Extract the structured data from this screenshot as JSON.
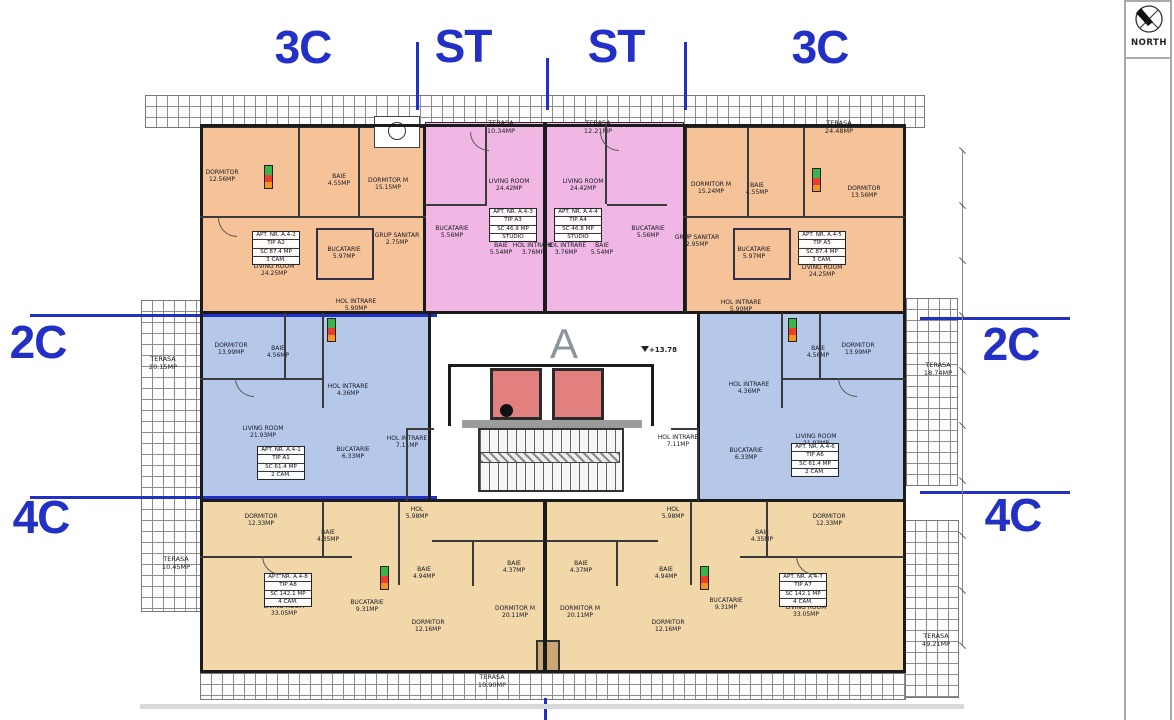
{
  "compass": {
    "label": "NORTH"
  },
  "core": {
    "letter": "A",
    "level": "+13.78"
  },
  "colors": {
    "accent_blue": "#2330c6",
    "apartment_3c_orange": "#f5c397",
    "apartment_st_pink": "#f0b6e4",
    "apartment_2c_blue": "#b5c8e9",
    "apartment_4c_tan": "#f2d7a9",
    "elevator_red": "#e28080"
  },
  "section_labels": [
    {
      "text": "3C",
      "x": 303,
      "y": 47
    },
    {
      "text": "ST",
      "x": 463,
      "y": 46
    },
    {
      "text": "ST",
      "x": 616,
      "y": 46
    },
    {
      "text": "3C",
      "x": 820,
      "y": 47
    },
    {
      "text": "2C",
      "x": 38,
      "y": 342
    },
    {
      "text": "4C",
      "x": 41,
      "y": 517
    },
    {
      "text": "2C",
      "x": 1011,
      "y": 344
    },
    {
      "text": "4C",
      "x": 1013,
      "y": 515
    }
  ],
  "apartment_boxes": [
    {
      "id": "a4-1",
      "lines": [
        "APT. NR. A.4-1",
        "TIP A1",
        "SC 61.4 MP",
        "2 CAM."
      ],
      "x": 281,
      "y": 463
    },
    {
      "id": "a4-2",
      "lines": [
        "APT. NR. A.4-2",
        "TIP A2",
        "SC 87.4 MP",
        "3 CAM."
      ],
      "x": 276,
      "y": 248
    },
    {
      "id": "a4-3",
      "lines": [
        "APT. NR. A.4-3",
        "TIP A3",
        "SC 46.9 MP",
        "STUDIO"
      ],
      "x": 513,
      "y": 225
    },
    {
      "id": "a4-4",
      "lines": [
        "APT. NR. A.4-4",
        "TIP A4",
        "SC 46.8 MP",
        "STUDIO"
      ],
      "x": 578,
      "y": 225
    },
    {
      "id": "a4-5",
      "lines": [
        "APT. NR. A.4-5",
        "TIP A5",
        "SC 87.4 MP",
        "3 CAM."
      ],
      "x": 822,
      "y": 248
    },
    {
      "id": "a4-6",
      "lines": [
        "APT. NR. A.4-6",
        "TIP A6",
        "SC 61.4 MP",
        "2 CAM."
      ],
      "x": 815,
      "y": 460
    },
    {
      "id": "a4-7",
      "lines": [
        "APT. NR. A.4-7",
        "TIP A7",
        "SC 142.1 MP",
        "4 CAM."
      ],
      "x": 803,
      "y": 590
    },
    {
      "id": "a4-8",
      "lines": [
        "APT. NR. A.4-8",
        "TIP A8",
        "SC 142.1 MP",
        "4 CAM."
      ],
      "x": 288,
      "y": 590
    }
  ],
  "room_labels": [
    {
      "lines": [
        "DORMITOR",
        "12.56MP"
      ],
      "x": 222,
      "y": 176
    },
    {
      "lines": [
        "BAIE",
        "4.55MP"
      ],
      "x": 339,
      "y": 180
    },
    {
      "lines": [
        "DORMITOR M",
        "15.15MP"
      ],
      "x": 388,
      "y": 184
    },
    {
      "lines": [
        "GRUP SANITAR",
        "2.75MP"
      ],
      "x": 397,
      "y": 239
    },
    {
      "lines": [
        "BUCATARIE",
        "5.97MP"
      ],
      "x": 344,
      "y": 253
    },
    {
      "lines": [
        "LIVING ROOM",
        "24.25MP"
      ],
      "x": 274,
      "y": 270
    },
    {
      "lines": [
        "HOL INTRARE",
        "5.90MP"
      ],
      "x": 356,
      "y": 305
    },
    {
      "lines": [
        "LIVING ROOM",
        "24.42MP"
      ],
      "x": 509,
      "y": 185
    },
    {
      "lines": [
        "BUCATARIE",
        "5.56MP"
      ],
      "x": 452,
      "y": 232
    },
    {
      "lines": [
        "BAIE",
        "5.54MP"
      ],
      "x": 501,
      "y": 249
    },
    {
      "lines": [
        "HOL INTRARE",
        "3.76MP"
      ],
      "x": 533,
      "y": 249
    },
    {
      "lines": [
        "LIVING ROOM",
        "24.42MP"
      ],
      "x": 583,
      "y": 185
    },
    {
      "lines": [
        "HOL INTRARE",
        "3.76MP"
      ],
      "x": 566,
      "y": 249
    },
    {
      "lines": [
        "BAIE",
        "5.54MP"
      ],
      "x": 602,
      "y": 249
    },
    {
      "lines": [
        "BUCATARIE",
        "5.56MP"
      ],
      "x": 648,
      "y": 232
    },
    {
      "lines": [
        "DORMITOR M",
        "15.24MP"
      ],
      "x": 711,
      "y": 188
    },
    {
      "lines": [
        "BAIE",
        "4.55MP"
      ],
      "x": 757,
      "y": 189
    },
    {
      "lines": [
        "DORMITOR",
        "13.56MP"
      ],
      "x": 864,
      "y": 192
    },
    {
      "lines": [
        "GRUP SANITAR",
        "2.95MP"
      ],
      "x": 697,
      "y": 241
    },
    {
      "lines": [
        "BUCATARIE",
        "5.97MP"
      ],
      "x": 754,
      "y": 253
    },
    {
      "lines": [
        "LIVING ROOM",
        "24.25MP"
      ],
      "x": 822,
      "y": 271
    },
    {
      "lines": [
        "HOL INTRARE",
        "5.90MP"
      ],
      "x": 741,
      "y": 306
    },
    {
      "lines": [
        "DORMITOR",
        "13.99MP"
      ],
      "x": 231,
      "y": 349
    },
    {
      "lines": [
        "BAIE",
        "4.56MP"
      ],
      "x": 278,
      "y": 352
    },
    {
      "lines": [
        "HOL INTRARE",
        "4.36MP"
      ],
      "x": 348,
      "y": 390
    },
    {
      "lines": [
        "LIVING ROOM",
        "21.93MP"
      ],
      "x": 263,
      "y": 432
    },
    {
      "lines": [
        "BUCATARIE",
        "6.33MP"
      ],
      "x": 353,
      "y": 453
    },
    {
      "lines": [
        "BAIE",
        "4.56MP"
      ],
      "x": 818,
      "y": 352
    },
    {
      "lines": [
        "DORMITOR",
        "13.99MP"
      ],
      "x": 858,
      "y": 349
    },
    {
      "lines": [
        "HOL INTRARE",
        "4.36MP"
      ],
      "x": 749,
      "y": 388
    },
    {
      "lines": [
        "LIVING ROOM",
        "21.93MP"
      ],
      "x": 816,
      "y": 440
    },
    {
      "lines": [
        "BUCATARIE",
        "6.33MP"
      ],
      "x": 746,
      "y": 454
    },
    {
      "lines": [
        "HOL INTRARE",
        "7.11MP"
      ],
      "x": 407,
      "y": 442
    },
    {
      "lines": [
        "HOL INTRARE",
        "7.11MP"
      ],
      "x": 678,
      "y": 441
    },
    {
      "lines": [
        "HOL",
        "5.98MP"
      ],
      "x": 417,
      "y": 513
    },
    {
      "lines": [
        "HOL",
        "5.98MP"
      ],
      "x": 673,
      "y": 513
    },
    {
      "lines": [
        "DORMITOR",
        "12.33MP"
      ],
      "x": 261,
      "y": 520
    },
    {
      "lines": [
        "BAIE",
        "4.35MP"
      ],
      "x": 328,
      "y": 536
    },
    {
      "lines": [
        "LIVING ROOM",
        "33.05MP"
      ],
      "x": 284,
      "y": 610
    },
    {
      "lines": [
        "BUCATARIE",
        "9.31MP"
      ],
      "x": 367,
      "y": 606
    },
    {
      "lines": [
        "DORMITOR",
        "12.16MP"
      ],
      "x": 428,
      "y": 626
    },
    {
      "lines": [
        "BAIE",
        "4.94MP"
      ],
      "x": 424,
      "y": 573
    },
    {
      "lines": [
        "BAIE",
        "4.37MP"
      ],
      "x": 514,
      "y": 567
    },
    {
      "lines": [
        "DORMITOR M",
        "20.11MP"
      ],
      "x": 515,
      "y": 612
    },
    {
      "lines": [
        "BAIE",
        "4.37MP"
      ],
      "x": 581,
      "y": 567
    },
    {
      "lines": [
        "DORMITOR M",
        "20.11MP"
      ],
      "x": 580,
      "y": 612
    },
    {
      "lines": [
        "BAIE",
        "4.94MP"
      ],
      "x": 666,
      "y": 573
    },
    {
      "lines": [
        "DORMITOR",
        "12.16MP"
      ],
      "x": 668,
      "y": 626
    },
    {
      "lines": [
        "BUCATARIE",
        "9.31MP"
      ],
      "x": 726,
      "y": 604
    },
    {
      "lines": [
        "LIVING ROOM",
        "33.05MP"
      ],
      "x": 806,
      "y": 611
    },
    {
      "lines": [
        "DORMITOR",
        "12.33MP"
      ],
      "x": 829,
      "y": 520
    },
    {
      "lines": [
        "BAIE",
        "4.35MP"
      ],
      "x": 762,
      "y": 536
    }
  ],
  "terrace_labels": [
    {
      "lines": [
        "TERASA",
        "10.34MP"
      ],
      "x": 501,
      "y": 128
    },
    {
      "lines": [
        "TERASA",
        "12.21MP"
      ],
      "x": 598,
      "y": 128
    },
    {
      "lines": [
        "TERASA",
        "24.48MP"
      ],
      "x": 839,
      "y": 128
    },
    {
      "lines": [
        "TERASA",
        "20.15MP"
      ],
      "x": 163,
      "y": 364
    },
    {
      "lines": [
        "TERASA",
        "18.74MP"
      ],
      "x": 938,
      "y": 370
    },
    {
      "lines": [
        "TERASA",
        "10.45MP"
      ],
      "x": 176,
      "y": 564
    },
    {
      "lines": [
        "TERASA",
        "10.90MP"
      ],
      "x": 492,
      "y": 682
    },
    {
      "lines": [
        "TERASA",
        "49.21MP"
      ],
      "x": 936,
      "y": 641
    }
  ]
}
